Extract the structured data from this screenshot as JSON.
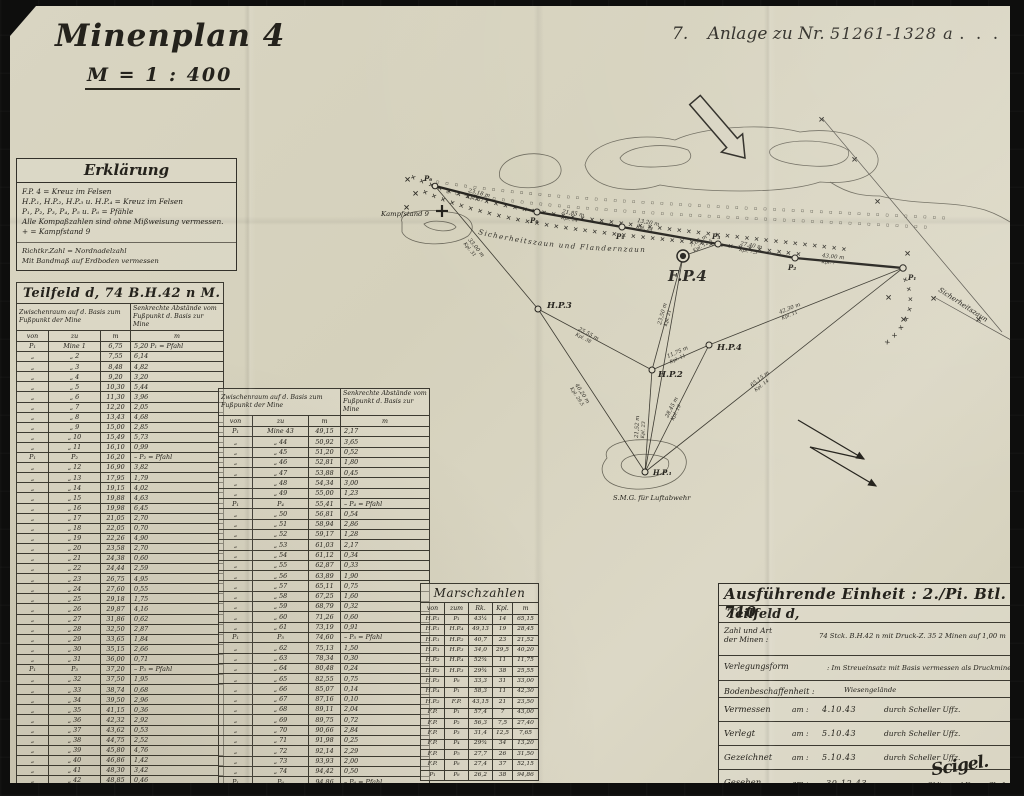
{
  "page": {
    "title": "Minenplan 4",
    "scale": "M = 1 : 400",
    "annex": {
      "num": "7.",
      "label": "Anlage zu Nr.",
      "value": "51261-1328 a",
      "dots": ". . . . . ."
    }
  },
  "legend": {
    "title": "Erklärung",
    "lines": [
      "F.P. 4 = Kreuz im Felsen",
      "H.P.₁, H.P.₂, H.P.₃ u. H.P.₄ = Kreuz im Felsen",
      "P₁, P₂, P₃, P₄, P₅ u. P₆  = Pfähle",
      "Alle Kompaßzahlen sind ohne Mißweisung vermessen.",
      "+ = Kampfstand 9"
    ],
    "notes": [
      "Richtkr.Zahl = Nordnadelzahl",
      "Mit Bandmaß auf Erdboden vermessen"
    ]
  },
  "table1": {
    "title": "Teilfeld d, 74 B.H.42 n M.",
    "head_left": "Zwischenraum auf d. Basis zum Fußpunkt der Mine",
    "head_right": "Senkrechte Abstände vom Fußpunkt d. Basis zur Mine",
    "cols": [
      "von",
      "zu",
      "m",
      "m"
    ],
    "rows": [
      [
        "P₁",
        "Mine 1",
        "6,75",
        "5,20   P₁ = Pfahl"
      ],
      [
        "„",
        "„  2",
        "7,55",
        "6,14"
      ],
      [
        "„",
        "„  3",
        "8,48",
        "4,82"
      ],
      [
        "„",
        "„  4",
        "9,20",
        "3,20"
      ],
      [
        "„",
        "„  5",
        "10,30",
        "5,44"
      ],
      [
        "„",
        "„  6",
        "11,30",
        "3,96"
      ],
      [
        "„",
        "„  7",
        "12,20",
        "2,05"
      ],
      [
        "„",
        "„  8",
        "13,43",
        "4,68"
      ],
      [
        "„",
        "„  9",
        "15,00",
        "2,85"
      ],
      [
        "„",
        "„  10",
        "15,49",
        "5,73"
      ],
      [
        "„",
        "„  11",
        "16,10",
        "0,99"
      ],
      [
        "P₁",
        "P₂",
        "16,20",
        "–   P₂ = Pfahl"
      ],
      [
        "„",
        "„  12",
        "16,90",
        "3,82"
      ],
      [
        "„",
        "„  13",
        "17,95",
        "1,79"
      ],
      [
        "„",
        "„  14",
        "19,15",
        "4,02"
      ],
      [
        "„",
        "„  15",
        "19,88",
        "4,63"
      ],
      [
        "„",
        "„  16",
        "19,98",
        "6,45"
      ],
      [
        "„",
        "„  17",
        "21,05",
        "2,70"
      ],
      [
        "„",
        "„  18",
        "22,05",
        "0,70"
      ],
      [
        "„",
        "„  19",
        "22,26",
        "4,90"
      ],
      [
        "„",
        "„  20",
        "23,58",
        "2,70"
      ],
      [
        "„",
        "„  21",
        "24,38",
        "0,60"
      ],
      [
        "„",
        "„  22",
        "24,44",
        "2,59"
      ],
      [
        "„",
        "„  23",
        "26,75",
        "4,95"
      ],
      [
        "„",
        "„  24",
        "27,60",
        "0,55"
      ],
      [
        "„",
        "„  25",
        "29,18",
        "1,75"
      ],
      [
        "„",
        "„  26",
        "29,87",
        "4,16"
      ],
      [
        "„",
        "„  27",
        "31,86",
        "0,62"
      ],
      [
        "„",
        "„  28",
        "32,50",
        "2,87"
      ],
      [
        "„",
        "„  29",
        "33,65",
        "1,84"
      ],
      [
        "„",
        "„  30",
        "35,15",
        "2,66"
      ],
      [
        "„",
        "„  31",
        "36,00",
        "0,71"
      ],
      [
        "P₁",
        "P₃",
        "37,20",
        "–   P₃ = Pfahl"
      ],
      [
        "„",
        "„  32",
        "37,50",
        "1,95"
      ],
      [
        "„",
        "„  33",
        "38,74",
        "0,68"
      ],
      [
        "„",
        "„  34",
        "39,50",
        "2,96"
      ],
      [
        "„",
        "„  35",
        "41,15",
        "0,36"
      ],
      [
        "„",
        "„  36",
        "42,32",
        "2,92"
      ],
      [
        "„",
        "„  37",
        "43,62",
        "0,53"
      ],
      [
        "„",
        "„  38",
        "44,75",
        "2,52"
      ],
      [
        "„",
        "„  39",
        "45,80",
        "4,76"
      ],
      [
        "„",
        "„  40",
        "46,86",
        "1,42"
      ],
      [
        "„",
        "„  41",
        "48,30",
        "3,42"
      ],
      [
        "„",
        "„  42",
        "48,85",
        "0,46"
      ]
    ]
  },
  "table2": {
    "head_left": "Zwischenraum auf d. Basis zum Fußpunkt der Mine",
    "head_right": "Senkrechte Abstände vom Fußpunkt d. Basis zur Mine",
    "cols": [
      "von",
      "zu",
      "m",
      "m"
    ],
    "rows": [
      [
        "P₁",
        "Mine 43",
        "49,15",
        "2,17"
      ],
      [
        "„",
        "„  44",
        "50,92",
        "3,65"
      ],
      [
        "„",
        "„  45",
        "51,20",
        "0,52"
      ],
      [
        "„",
        "„  46",
        "52,81",
        "1,80"
      ],
      [
        "„",
        "„  47",
        "53,88",
        "0,45"
      ],
      [
        "„",
        "„  48",
        "54,34",
        "3,00"
      ],
      [
        "„",
        "„  49",
        "55,00",
        "1,23"
      ],
      [
        "P₁",
        "P₄",
        "55,41",
        "–   P₄ = Pfahl"
      ],
      [
        "„",
        "„  50",
        "56,81",
        "0,54"
      ],
      [
        "„",
        "„  51",
        "58,94",
        "2,86"
      ],
      [
        "„",
        "„  52",
        "59,17",
        "1,28"
      ],
      [
        "„",
        "„  53",
        "61,03",
        "2,17"
      ],
      [
        "„",
        "„  54",
        "61,12",
        "0,34"
      ],
      [
        "„",
        "„  55",
        "62,87",
        "0,33"
      ],
      [
        "„",
        "„  56",
        "63,89",
        "1,90"
      ],
      [
        "„",
        "„  57",
        "65,11",
        "0,75"
      ],
      [
        "„",
        "„  58",
        "67,25",
        "1,60"
      ],
      [
        "„",
        "„  59",
        "68,79",
        "0,32"
      ],
      [
        "„",
        "„  60",
        "71,26",
        "0,60"
      ],
      [
        "„",
        "„  61",
        "73,19",
        "0,91"
      ],
      [
        "P₁",
        "P₅",
        "74,60",
        "–   P₅ = Pfahl"
      ],
      [
        "„",
        "„  62",
        "75,13",
        "1,50"
      ],
      [
        "„",
        "„  63",
        "78,34",
        "0,30"
      ],
      [
        "„",
        "„  64",
        "80,48",
        "0,24"
      ],
      [
        "„",
        "„  65",
        "82,55",
        "0,75"
      ],
      [
        "„",
        "„  66",
        "85,07",
        "0,14"
      ],
      [
        "„",
        "„  67",
        "87,16",
        "0,10"
      ],
      [
        "„",
        "„  68",
        "89,11",
        "2,04"
      ],
      [
        "„",
        "„  69",
        "89,75",
        "0,72"
      ],
      [
        "„",
        "„  70",
        "90,66",
        "2,84"
      ],
      [
        "„",
        "„  71",
        "91,98",
        "0,25"
      ],
      [
        "„",
        "„  72",
        "92,14",
        "2,29"
      ],
      [
        "„",
        "„  73",
        "93,93",
        "2,00"
      ],
      [
        "„",
        "„  74",
        "94,42",
        "0,50"
      ],
      [
        "P₁",
        "P₆",
        "94,86",
        "–   P₆ = Pfahl"
      ]
    ]
  },
  "marsch": {
    "title": "Marschzahlen",
    "cols": [
      "von",
      "zum",
      "Rk.",
      "Kpl.",
      "m"
    ],
    "rows": [
      [
        "H.P.₁",
        "P₁",
        "43¼",
        "14",
        "65,15"
      ],
      [
        "H.P.₁",
        "H.P.₄",
        "49,13",
        "19",
        "28,45"
      ],
      [
        "H.P.₁",
        "H.P.₂",
        "40,7",
        "23",
        "21,52"
      ],
      [
        "H.P.₁",
        "H.P.₃",
        "34,0",
        "29,5",
        "40,20"
      ],
      [
        "H.P.₂",
        "H.P.₄",
        "52¾",
        "11",
        "11,75"
      ],
      [
        "H.P.₂",
        "H.P.₃",
        "29¾",
        "38",
        "25,55"
      ],
      [
        "H.P.₃",
        "P₆",
        "33,3",
        "31",
        "33,00"
      ],
      [
        "H.P.₄",
        "P₁",
        "58,3",
        "11",
        "42,30"
      ],
      [
        "H.P.₂",
        "F.P.",
        "43,15",
        "21",
        "23,50"
      ],
      [
        "F.P.",
        "P₁",
        "57,4",
        "7",
        "43,00"
      ],
      [
        "F.P.",
        "P₂",
        "56,3",
        "7,5",
        "27,40"
      ],
      [
        "F.P.",
        "P₃",
        "31,4",
        "12,5",
        "7,65"
      ],
      [
        "F.P.",
        "P₄",
        "29¾",
        "34",
        "13,20"
      ],
      [
        "F.P.",
        "P₅",
        "27,7",
        "26",
        "31,50"
      ],
      [
        "F.P.",
        "P₆",
        "27,4",
        "37",
        "52,15"
      ],
      [
        "P₁",
        "P₆",
        "26,2",
        "38",
        "94,86"
      ]
    ]
  },
  "info": {
    "title": "Ausführende Einheit : 2./Pi. Btl. 710",
    "subtitle": "Teilfeld  d,",
    "mines_label_1": "Zahl und Art",
    "mines_label_2": "der Minen      :",
    "mines_value": "74 Stck.  B.H.42 n  mit Druck-Z. 35    2 Minen auf 1,00 m",
    "form_label": "Verlegungsform",
    "form_value": ": Im Streueinsatz mit Basis vermessen als Druckminen",
    "ground_label": "Bodenbeschaffenheit :",
    "ground_value": "Wiesengelände",
    "log_rows": [
      {
        "label": "Vermessen",
        "am": "am :",
        "date": "4.10.43",
        "by": "durch Scheller Uffz."
      },
      {
        "label": "Verlegt",
        "am": "am :",
        "date": "5.10.43",
        "by": "durch Scheller Uffz."
      },
      {
        "label": "Gezeichnet",
        "am": "am :",
        "date": "5.10.43",
        "by": "durch Scheller Uffz."
      }
    ],
    "seen": {
      "label": "Gesehen",
      "am": "am :",
      "date": "30.12.43"
    },
    "signature": "Scigel.",
    "sig_title": "Obltn. und Komp. Chef"
  },
  "map": {
    "labels": {
      "kampfstand": "Kampfstand 9",
      "fp4": "F.P.4",
      "hp1": "H.P.₁",
      "hp2": "H.P.2",
      "hp3": "H.P.3",
      "hp4": "H.P.4",
      "p1": "P₁",
      "p2": "P₂",
      "p3": "P₃",
      "p4": "P₄",
      "p5": "P₅",
      "p6": "P₆",
      "smg": "S.M.G. für Luftabwehr",
      "fence_long": "Sicherheitszaun  und  Flandernzaun",
      "fence_right": "Sicherheitszaun"
    },
    "meas": {
      "seg65": {
        "m": "23,18 m",
        "k": "Kpl. 37"
      },
      "seg54": {
        "m": "21,85 m",
        "k": "Kpl. 34"
      },
      "seg4f": {
        "m": "13,20 m",
        "k": "Kpl. 34"
      },
      "fp3": {
        "m": "7,65 m",
        "k": "Kpl. 12,5"
      },
      "p32": {
        "m": "27,40 m",
        "k": "Kpl. 7,5"
      },
      "p21": {
        "m": "43,00 m",
        "k": "Kpl. 7"
      },
      "hp3p6": {
        "m": "33,00 m",
        "k": "Kpl. 31"
      },
      "hp32": {
        "m": "25,55 m",
        "k": "Kpl. 38"
      },
      "hp31": {
        "m": "40,20 m",
        "k": "Kpl. 29,5"
      },
      "hp2fp": {
        "m": "23,50 m",
        "k": "Kpl. 21"
      },
      "hp24": {
        "m": "11,75 m",
        "k": "Kpl. 11"
      },
      "hp21": {
        "m": "21,52 m",
        "k": "Kpl. 23"
      },
      "hp41": {
        "m": "28,45 m",
        "k": "Kpl. 19"
      },
      "hp4p1": {
        "m": "42,30 m",
        "k": "Kpl. 11"
      },
      "hp1p1": {
        "m": "65,15 m",
        "k": "Kpl. 14"
      }
    },
    "sym": {
      "x": "×",
      "fence_a1": "××××××××××××××××××××××××××××××××××××××××××××××",
      "fence_a2": "××××××××××××××××××××××××××××××××××××××××",
      "fence_c": "××××××××",
      "mines1": "▫▫▫▫▫▫▫▫▫▫▫▫▫▫▫▫▫▫▫▫▫▫▫▫▫▫▫▫▫▫▫▫▫▫▫▫▫▫▫▫▫▫▫▫▫▫▫▫▫▫▫▫▫▫▫",
      "mines2": "▫▫▫▫▫▫▫▫▫▫▫▫▫▫▫▫▫▫▫▫▫▫▫▫▫▫▫▫▫▫▫▫▫▫▫▫▫▫▫▫▫▫▫▫▫▫▫▫▫▫▫▫"
    }
  }
}
